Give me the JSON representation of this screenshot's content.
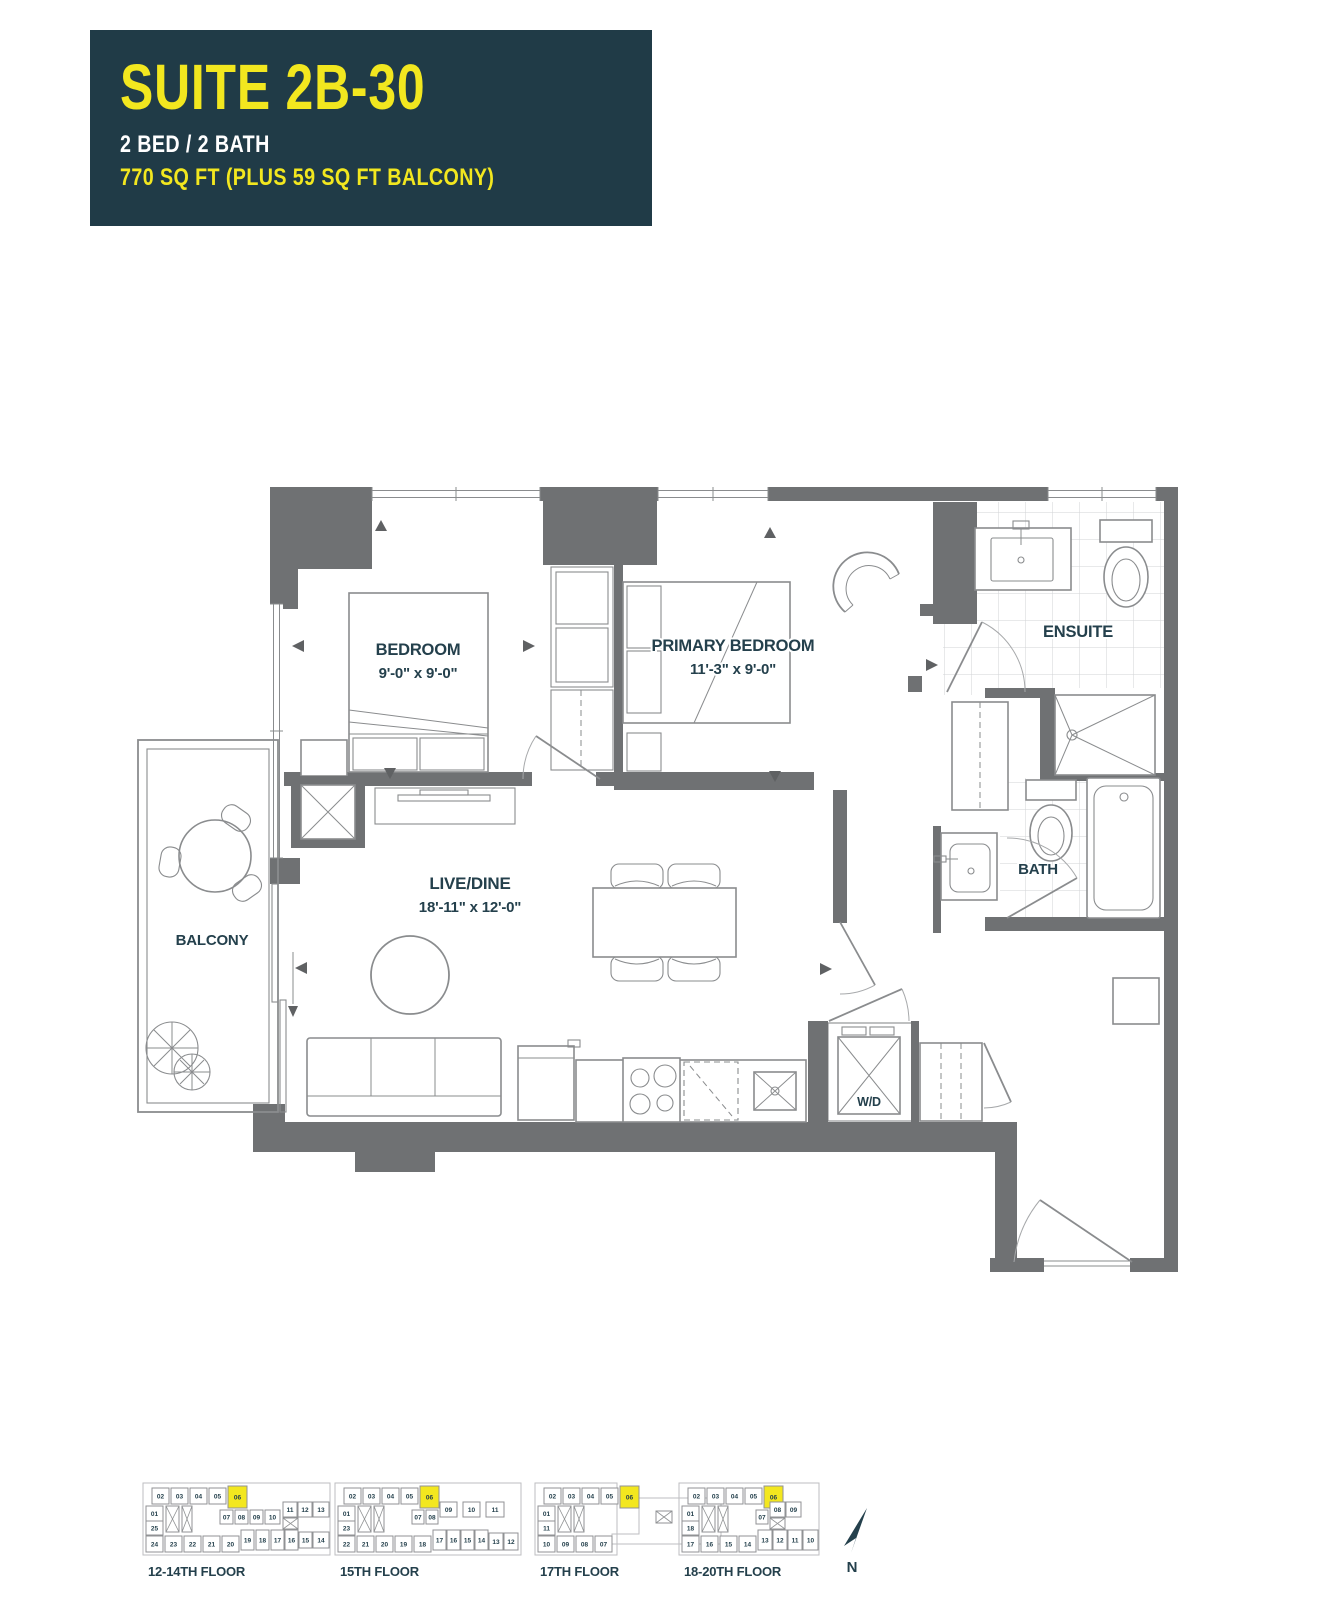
{
  "colors": {
    "header_bg": "#203B47",
    "accent_yellow": "#F2E71F",
    "wall": "#6F7173",
    "line": "#8A8C8E",
    "text": "#24404C",
    "highlight": "#F3E71F",
    "arrow": "#5F6163",
    "tile": "#D2D3D5"
  },
  "header": {
    "suite_name": "SUITE 2B-30",
    "bed_bath": "2 BED / 2 BATH",
    "area": "770 SQ FT (PLUS 59 SQ FT BALCONY)"
  },
  "rooms": {
    "bedroom": {
      "name": "BEDROOM",
      "dims": "9'-0\" x 9'-0\""
    },
    "primary_bedroom": {
      "name": "PRIMARY BEDROOM",
      "dims": "11'-3\" x 9'-0\""
    },
    "live_dine": {
      "name": "LIVE/DINE",
      "dims": "18'-11\" x 12'-0\""
    },
    "ensuite": {
      "name": "ENSUITE"
    },
    "bath": {
      "name": "BATH"
    },
    "balcony": {
      "name": "BALCONY"
    },
    "laundry": {
      "name": "W/D"
    }
  },
  "north_label": "N",
  "keyplans": [
    {
      "label": "12-14TH FLOOR",
      "x": 146,
      "y": 1484,
      "lx": 148,
      "ly": 1576,
      "outline": [
        -3,
        -1,
        187,
        72
      ],
      "cores": [
        [
          20,
          22,
          13,
          26
        ],
        [
          36,
          22,
          10,
          26
        ]
      ],
      "xboxes": [
        [
          137,
          34,
          15,
          11
        ]
      ],
      "units": [
        {
          "n": "02",
          "x": 6,
          "y": 4
        },
        {
          "n": "03",
          "x": 25,
          "y": 4
        },
        {
          "n": "04",
          "x": 44,
          "y": 4
        },
        {
          "n": "05",
          "x": 63,
          "y": 4
        },
        {
          "n": "06",
          "x": 82,
          "y": 2,
          "w": 19,
          "h": 22,
          "hl": true
        },
        {
          "n": "01",
          "x": 0,
          "y": 22,
          "w": 17,
          "h": 15
        },
        {
          "n": "25",
          "x": 0,
          "y": 37,
          "w": 17,
          "h": 14
        },
        {
          "n": "07",
          "x": 74,
          "y": 26,
          "w": 13,
          "h": 14
        },
        {
          "n": "08",
          "x": 89,
          "y": 26,
          "w": 13,
          "h": 14
        },
        {
          "n": "09",
          "x": 104,
          "y": 26,
          "w": 13,
          "h": 14
        },
        {
          "n": "10",
          "x": 119,
          "y": 26,
          "w": 15,
          "h": 14
        },
        {
          "n": "11",
          "x": 137,
          "y": 18,
          "w": 14,
          "h": 15
        },
        {
          "n": "12",
          "x": 152,
          "y": 18,
          "w": 14,
          "h": 15
        },
        {
          "n": "13",
          "x": 167,
          "y": 18,
          "w": 16,
          "h": 15
        },
        {
          "n": "24",
          "x": 0,
          "y": 52
        },
        {
          "n": "23",
          "x": 19,
          "y": 52
        },
        {
          "n": "22",
          "x": 38,
          "y": 52
        },
        {
          "n": "21",
          "x": 57,
          "y": 52
        },
        {
          "n": "20",
          "x": 76,
          "y": 52
        },
        {
          "n": "19",
          "x": 95,
          "y": 46,
          "w": 13,
          "h": 20
        },
        {
          "n": "18",
          "x": 110,
          "y": 46,
          "w": 13,
          "h": 20
        },
        {
          "n": "17",
          "x": 125,
          "y": 46,
          "w": 13,
          "h": 20
        },
        {
          "n": "16",
          "x": 139,
          "y": 46,
          "w": 13,
          "h": 20
        },
        {
          "n": "15",
          "x": 153,
          "y": 48,
          "w": 13,
          "h": 16
        },
        {
          "n": "14",
          "x": 167,
          "y": 48,
          "w": 16,
          "h": 16
        }
      ]
    },
    {
      "label": "15TH FLOOR",
      "x": 338,
      "y": 1484,
      "lx": 340,
      "ly": 1576,
      "outline": [
        -3,
        -1,
        186,
        72
      ],
      "cores": [
        [
          20,
          22,
          13,
          26
        ],
        [
          36,
          22,
          10,
          26
        ]
      ],
      "xboxes": [],
      "units": [
        {
          "n": "02",
          "x": 6,
          "y": 4
        },
        {
          "n": "03",
          "x": 25,
          "y": 4
        },
        {
          "n": "04",
          "x": 44,
          "y": 4
        },
        {
          "n": "05",
          "x": 63,
          "y": 4
        },
        {
          "n": "06",
          "x": 82,
          "y": 2,
          "w": 19,
          "h": 22,
          "hl": true
        },
        {
          "n": "01",
          "x": 0,
          "y": 22,
          "w": 17,
          "h": 15
        },
        {
          "n": "23",
          "x": 0,
          "y": 37,
          "w": 17,
          "h": 14
        },
        {
          "n": "07",
          "x": 74,
          "y": 26,
          "w": 12,
          "h": 14
        },
        {
          "n": "08",
          "x": 88,
          "y": 26,
          "w": 12,
          "h": 14
        },
        {
          "n": "09",
          "x": 102,
          "y": 18,
          "w": 17,
          "h": 15
        },
        {
          "n": "10",
          "x": 125,
          "y": 18,
          "w": 17,
          "h": 15
        },
        {
          "n": "11",
          "x": 148,
          "y": 18,
          "w": 18,
          "h": 15
        },
        {
          "n": "22",
          "x": 0,
          "y": 52
        },
        {
          "n": "21",
          "x": 19,
          "y": 52
        },
        {
          "n": "20",
          "x": 38,
          "y": 52
        },
        {
          "n": "19",
          "x": 57,
          "y": 52
        },
        {
          "n": "18",
          "x": 76,
          "y": 52
        },
        {
          "n": "17",
          "x": 95,
          "y": 46,
          "w": 13,
          "h": 20
        },
        {
          "n": "16",
          "x": 109,
          "y": 46,
          "w": 13,
          "h": 20
        },
        {
          "n": "15",
          "x": 123,
          "y": 46,
          "w": 13,
          "h": 20
        },
        {
          "n": "14",
          "x": 137,
          "y": 46,
          "w": 13,
          "h": 20
        },
        {
          "n": "13",
          "x": 151,
          "y": 49,
          "w": 14,
          "h": 17
        },
        {
          "n": "12",
          "x": 166,
          "y": 49,
          "w": 14,
          "h": 17
        }
      ]
    },
    {
      "label": "17TH FLOOR",
      "x": 538,
      "y": 1484,
      "lx": 540,
      "ly": 1576,
      "outline": [
        -3,
        -1,
        82,
        72
      ],
      "wing": [
        [
          101,
          14
        ],
        [
          183,
          14
        ],
        [
          183,
          60
        ],
        [
          74,
          60
        ],
        [
          74,
          50
        ],
        [
          101,
          50
        ]
      ],
      "cores": [
        [
          20,
          22,
          13,
          26
        ],
        [
          36,
          22,
          10,
          26
        ]
      ],
      "xboxes": [
        [
          118,
          27,
          16,
          12
        ]
      ],
      "units": [
        {
          "n": "02",
          "x": 6,
          "y": 4
        },
        {
          "n": "03",
          "x": 25,
          "y": 4
        },
        {
          "n": "04",
          "x": 44,
          "y": 4
        },
        {
          "n": "05",
          "x": 63,
          "y": 4
        },
        {
          "n": "06",
          "x": 82,
          "y": 2,
          "w": 19,
          "h": 22,
          "hl": true
        },
        {
          "n": "01",
          "x": 0,
          "y": 22,
          "w": 17,
          "h": 15
        },
        {
          "n": "11",
          "x": 0,
          "y": 37,
          "w": 17,
          "h": 14
        },
        {
          "n": "10",
          "x": 0,
          "y": 52
        },
        {
          "n": "09",
          "x": 19,
          "y": 52
        },
        {
          "n": "08",
          "x": 38,
          "y": 52
        },
        {
          "n": "07",
          "x": 57,
          "y": 52
        }
      ]
    },
    {
      "label": "18-20TH FLOOR",
      "x": 682,
      "y": 1484,
      "lx": 684,
      "ly": 1576,
      "outline": [
        -3,
        -1,
        140,
        72
      ],
      "cores": [
        [
          20,
          22,
          13,
          26
        ],
        [
          36,
          22,
          10,
          26
        ]
      ],
      "xboxes": [
        [
          88,
          34,
          15,
          11
        ]
      ],
      "units": [
        {
          "n": "02",
          "x": 6,
          "y": 4
        },
        {
          "n": "03",
          "x": 25,
          "y": 4
        },
        {
          "n": "04",
          "x": 44,
          "y": 4
        },
        {
          "n": "05",
          "x": 63,
          "y": 4
        },
        {
          "n": "06",
          "x": 82,
          "y": 2,
          "w": 19,
          "h": 22,
          "hl": true
        },
        {
          "n": "01",
          "x": 0,
          "y": 22,
          "w": 17,
          "h": 15
        },
        {
          "n": "18",
          "x": 0,
          "y": 37,
          "w": 17,
          "h": 14
        },
        {
          "n": "07",
          "x": 74,
          "y": 26,
          "w": 12,
          "h": 14
        },
        {
          "n": "08",
          "x": 88,
          "y": 18,
          "w": 15,
          "h": 15
        },
        {
          "n": "09",
          "x": 104,
          "y": 18,
          "w": 15,
          "h": 15
        },
        {
          "n": "17",
          "x": 0,
          "y": 52
        },
        {
          "n": "16",
          "x": 19,
          "y": 52
        },
        {
          "n": "15",
          "x": 38,
          "y": 52
        },
        {
          "n": "14",
          "x": 57,
          "y": 52
        },
        {
          "n": "13",
          "x": 76,
          "y": 46,
          "w": 14,
          "h": 20
        },
        {
          "n": "12",
          "x": 91,
          "y": 46,
          "w": 14,
          "h": 20
        },
        {
          "n": "11",
          "x": 106,
          "y": 46,
          "w": 14,
          "h": 20
        },
        {
          "n": "10",
          "x": 121,
          "y": 46,
          "w": 15,
          "h": 20
        }
      ]
    }
  ]
}
